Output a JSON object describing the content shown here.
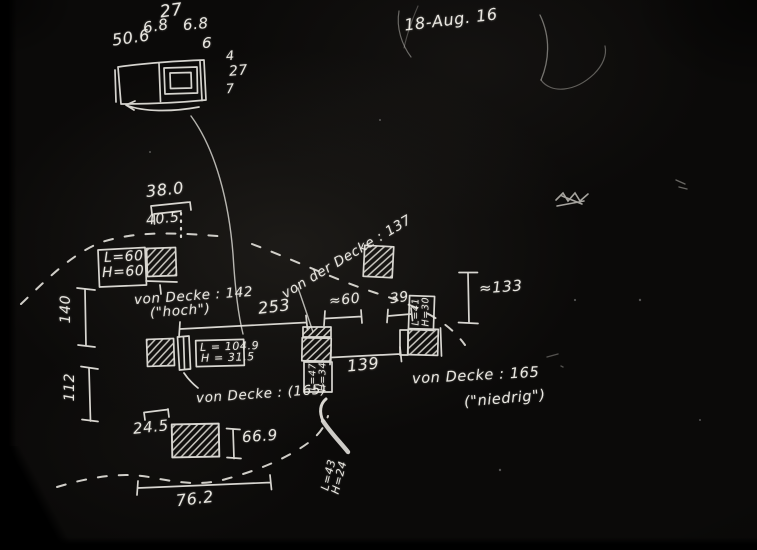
{
  "palette": {
    "background": "#0b0a09",
    "chalk": "#e8e6e1"
  },
  "note_date": "18-Aug. 16",
  "top_sketch": {
    "total_top": "27",
    "seg_left": "6.8",
    "seg_right": "6.8",
    "total_width": "50.6",
    "edge": "6",
    "side_a": "4",
    "side_b": "27",
    "side_c": "7"
  },
  "plan": {
    "dim_38_0": "38.0",
    "dim_40_5": "40.5",
    "unit_left": {
      "l": "L=60",
      "h": "H=60"
    },
    "ceiling_high": {
      "text": "von Decke : 142",
      "sub": "(\"hoch\")"
    },
    "dim_253": "253",
    "ceiling_mid": "von der Decke : 137",
    "dim_approx_60": "≈60",
    "dim_39": "39",
    "unit_right": {
      "l": "L=41",
      "h": "H=30"
    },
    "dim_approx_133": "≈133",
    "dim_140": "140",
    "dim_112": "112",
    "unit_mid_left": {
      "l": "L = 104.9",
      "h": "H = 31.5"
    },
    "ceiling_paren": "von Decke : (165)",
    "dim_139": "139",
    "ceiling_low": {
      "text": "von Decke : 165",
      "sub": "(\"niedrig\")"
    },
    "unit_mid": {
      "l": "L=47",
      "h": "H=34"
    },
    "unit_note": {
      "l": "L=43",
      "h": "H=24"
    },
    "dim_24_5": "24.5",
    "dim_66_9": "66.9",
    "dim_76_2": "76.2"
  }
}
